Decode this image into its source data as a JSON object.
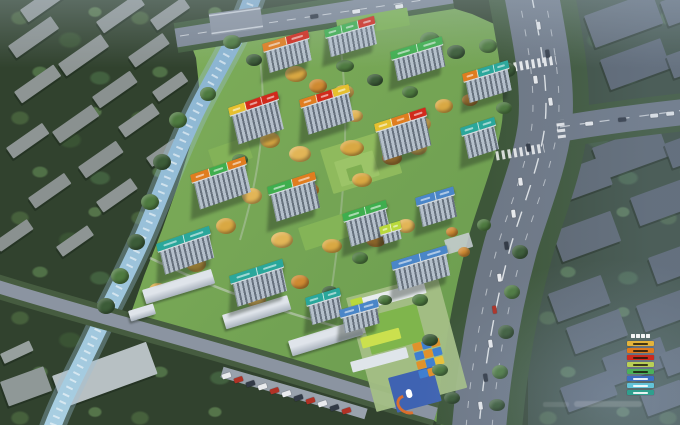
{
  "image": {
    "kind": "aerial-masterplan-render",
    "width": 680,
    "height": 425
  },
  "palette": {
    "banner_orange": "#e07d1f",
    "banner_red": "#d12a1c",
    "banner_yellow": "#e6c02e",
    "banner_green": "#3fae4e",
    "banner_teal": "#2aa79b",
    "banner_blue": "#4a86c8",
    "banner_lime": "#b9d93c",
    "river": "#8fb7d2",
    "road": "#6e7886",
    "dev_green": "#76a455",
    "forest": "#31422e",
    "autumn_tree": "#d9a843"
  },
  "legend": {
    "title_glyphs": 4,
    "entries": [
      {
        "color": "#e3b33b"
      },
      {
        "color": "#df7a1e"
      },
      {
        "color": "#cd2a1e"
      },
      {
        "color": "#b8cf56"
      },
      {
        "color": "#4bb05a"
      },
      {
        "color": "#3c6fc2"
      },
      {
        "color": "#63c3d8"
      },
      {
        "color": "#2f9f8e"
      }
    ]
  },
  "scene": {
    "context": [
      [
        20,
        10,
        58,
        15,
        -35,
        "#8e9594"
      ],
      [
        96,
        22,
        50,
        14,
        -35,
        "#8e9594"
      ],
      [
        8,
        46,
        52,
        15,
        -35,
        "#8a9190"
      ],
      [
        150,
        20,
        40,
        13,
        -35,
        "#8e9594"
      ],
      [
        58,
        64,
        52,
        15,
        -35,
        "#8e9594"
      ],
      [
        128,
        57,
        42,
        13,
        -35,
        "#8a9190"
      ],
      [
        14,
        92,
        48,
        14,
        -35,
        "#8e9594"
      ],
      [
        92,
        97,
        46,
        14,
        -35,
        "#8a9190"
      ],
      [
        152,
        92,
        36,
        12,
        -35,
        "#8e9594"
      ],
      [
        52,
        132,
        48,
        14,
        -35,
        "#8a9190"
      ],
      [
        118,
        127,
        42,
        13,
        -35,
        "#8e9594"
      ],
      [
        6,
        148,
        44,
        13,
        -35,
        "#8e9594"
      ],
      [
        78,
        167,
        46,
        14,
        -35,
        "#8a9190"
      ],
      [
        146,
        158,
        34,
        11,
        -35,
        "#8e9594"
      ],
      [
        28,
        198,
        44,
        13,
        -35,
        "#8a9190"
      ],
      [
        96,
        202,
        42,
        13,
        -35,
        "#8e9594"
      ],
      [
        -6,
        242,
        40,
        12,
        -35,
        "#8a9190"
      ],
      [
        56,
        247,
        38,
        12,
        -35,
        "#8e9594"
      ],
      [
        584,
        16,
        72,
        34,
        -20,
        "#5d6772"
      ],
      [
        660,
        2,
        40,
        26,
        -20,
        "#5d6772"
      ],
      [
        600,
        60,
        64,
        32,
        -20,
        "#5a6470"
      ],
      [
        666,
        56,
        32,
        24,
        -20,
        "#5d6772"
      ],
      [
        592,
        148,
        70,
        34,
        -20,
        "#5d6772"
      ],
      [
        664,
        144,
        32,
        26,
        -20,
        "#5a6470"
      ],
      [
        548,
        176,
        58,
        30,
        -20,
        "#5d6772"
      ],
      [
        630,
        198,
        54,
        30,
        -20,
        "#5a6470"
      ],
      [
        552,
        232,
        62,
        32,
        -20,
        "#5d6772"
      ],
      [
        648,
        258,
        40,
        28,
        -20,
        "#5a6470"
      ],
      [
        548,
        294,
        56,
        30,
        -20,
        "#5d6772"
      ],
      [
        636,
        306,
        48,
        28,
        -20,
        "#5a6470"
      ],
      [
        566,
        328,
        56,
        28,
        -20,
        "#5d6772"
      ],
      [
        602,
        358,
        62,
        30,
        -20,
        "#5a6470"
      ],
      [
        660,
        354,
        32,
        24,
        -20,
        "#5d6772"
      ],
      [
        560,
        388,
        52,
        26,
        -20,
        "#5a6470"
      ],
      [
        640,
        394,
        42,
        24,
        -20,
        "#5d6772"
      ],
      [
        52,
        376,
        100,
        34,
        -20,
        "#b7c0c3"
      ],
      [
        0,
        382,
        46,
        26,
        -20,
        "#8f9897"
      ],
      [
        0,
        354,
        32,
        11,
        -25,
        "#97a09e"
      ]
    ],
    "towers": [
      {
        "x": 262,
        "y": 44,
        "l": 48,
        "fh": 22,
        "r": -17,
        "c": [
          "#e07d1f",
          "#d12a1c"
        ]
      },
      {
        "x": 324,
        "y": 30,
        "l": 52,
        "fh": 20,
        "r": -16,
        "c": [
          "#3fae4e",
          "#3fae4e",
          "#d12a1c"
        ]
      },
      {
        "x": 390,
        "y": 52,
        "l": 54,
        "fh": 22,
        "r": -17,
        "c": [
          "#3fae4e",
          "#3fae4e"
        ]
      },
      {
        "x": 462,
        "y": 74,
        "l": 48,
        "fh": 22,
        "r": -17,
        "c": [
          "#e07d1f",
          "#2aa79b",
          "#2aa79b"
        ]
      },
      {
        "x": 228,
        "y": 108,
        "l": 52,
        "fh": 30,
        "r": -19,
        "c": [
          "#e6c02e",
          "#d12a1c",
          "#d12a1c"
        ]
      },
      {
        "x": 299,
        "y": 100,
        "l": 52,
        "fh": 28,
        "r": -18,
        "c": [
          "#e07d1f",
          "#d12a1c",
          "#e6c02e"
        ]
      },
      {
        "x": 374,
        "y": 124,
        "l": 54,
        "fh": 30,
        "r": -18,
        "c": [
          "#e6c02e",
          "#e07d1f",
          "#d12a1c"
        ]
      },
      {
        "x": 460,
        "y": 128,
        "l": 36,
        "fh": 24,
        "r": -18,
        "c": [
          "#2aa79b",
          "#2aa79b"
        ]
      },
      {
        "x": 190,
        "y": 175,
        "l": 58,
        "fh": 28,
        "r": -19,
        "c": [
          "#e07d1f",
          "#3fae4e",
          "#e07d1f"
        ]
      },
      {
        "x": 267,
        "y": 187,
        "l": 50,
        "fh": 28,
        "r": -18,
        "c": [
          "#3fae4e",
          "#e07d1f"
        ]
      },
      {
        "x": 342,
        "y": 214,
        "l": 46,
        "fh": 26,
        "r": -18,
        "c": [
          "#3fae4e",
          "#3fae4e"
        ]
      },
      {
        "x": 415,
        "y": 198,
        "l": 40,
        "fh": 22,
        "r": -17,
        "c": [
          "#4a86c8",
          "#4a86c8"
        ]
      },
      {
        "x": 391,
        "y": 262,
        "l": 58,
        "fh": 22,
        "r": -17,
        "c": [
          "#4a86c8",
          "#4a86c8"
        ]
      },
      {
        "x": 156,
        "y": 244,
        "l": 56,
        "fh": 24,
        "r": -19,
        "c": [
          "#2aa79b",
          "#2aa79b"
        ]
      },
      {
        "x": 229,
        "y": 276,
        "l": 56,
        "fh": 24,
        "r": -18,
        "c": [
          "#2aa79b",
          "#2aa79b"
        ]
      },
      {
        "x": 305,
        "y": 298,
        "l": 36,
        "fh": 20,
        "r": -17,
        "c": [
          "#2aa79b",
          "#2aa79b"
        ]
      },
      {
        "x": 339,
        "y": 310,
        "l": 40,
        "fh": 16,
        "r": -16,
        "c": [
          "#4a86c8",
          "#4a86c8"
        ]
      },
      {
        "x": 379,
        "y": 227,
        "l": 22,
        "fh": 10,
        "r": -17,
        "c": [
          "#b9d93c",
          "#b9d93c"
        ]
      }
    ],
    "lowrise": [
      [
        142,
        290,
        72,
        15,
        -17
      ],
      [
        128,
        311,
        26,
        11,
        -17
      ],
      [
        222,
        315,
        68,
        15,
        -17
      ],
      [
        288,
        341,
        74,
        16,
        -17
      ]
    ],
    "rects": [
      [
        320,
        150,
        72,
        46,
        -17,
        "#8fba5d",
        1
      ],
      [
        334,
        162,
        40,
        26,
        -17,
        "#9cc468",
        1
      ],
      [
        346,
        169,
        16,
        13,
        -17,
        "#7fae52",
        1
      ],
      [
        336,
        20,
        72,
        18,
        -10,
        "#7cb152",
        1
      ],
      [
        298,
        228,
        50,
        24,
        -18,
        "#84b457",
        1
      ],
      [
        208,
        150,
        40,
        22,
        -19,
        "#83b258",
        1
      ],
      [
        444,
        240,
        26,
        15,
        -17,
        "#c9cfd6",
        0.85
      ],
      [
        346,
        298,
        94,
        118,
        -15,
        "#a4bf86",
        0.95
      ],
      [
        354,
        300,
        72,
        12,
        -15,
        "#e8ecef",
        1
      ],
      [
        350,
        300,
        12,
        9,
        -15,
        "#b9d93c",
        1
      ],
      [
        366,
        302,
        9,
        4,
        -15,
        "#4a90d8",
        1
      ],
      [
        382,
        300,
        9,
        4,
        -15,
        "#4a90d8",
        1
      ],
      [
        352,
        326,
        52,
        10,
        -15,
        "#e4e9ed",
        1
      ],
      [
        350,
        362,
        58,
        11,
        -15,
        "#dfe5ea",
        1
      ],
      [
        362,
        318,
        56,
        38,
        -15,
        "#7fb54c",
        1
      ],
      [
        360,
        338,
        40,
        11,
        -15,
        "#cbe04e",
        1
      ],
      [
        388,
        378,
        46,
        36,
        -15,
        "#3f63b2",
        1
      ],
      [
        412,
        344,
        9,
        8,
        -15,
        "#e0922c",
        1
      ],
      [
        421,
        342,
        9,
        8,
        -15,
        "#3f7fd0",
        1
      ],
      [
        430,
        340,
        9,
        8,
        -15,
        "#e0922c",
        1
      ],
      [
        414,
        353,
        9,
        8,
        -15,
        "#3f7fd0",
        1
      ],
      [
        423,
        351,
        9,
        8,
        -15,
        "#e0922c",
        1
      ],
      [
        432,
        349,
        9,
        8,
        -15,
        "#3f7fd0",
        1
      ],
      [
        416,
        362,
        9,
        8,
        -15,
        "#e0922c",
        1
      ],
      [
        425,
        360,
        9,
        8,
        -15,
        "#3f7fd0",
        1
      ],
      [
        434,
        358,
        9,
        8,
        -15,
        "#e8c23a",
        1
      ],
      [
        418,
        371,
        9,
        8,
        -15,
        "#3f7fd0",
        1
      ],
      [
        427,
        369,
        9,
        8,
        -15,
        "#e0922c",
        1
      ],
      [
        436,
        367,
        9,
        8,
        -15,
        "#3f7fd0",
        1
      ],
      [
        405,
        390,
        6,
        9,
        -15,
        "#ffffff",
        1,
        3
      ]
    ],
    "blobs": [
      [
        296,
        74,
        11,
        8,
        "#d9a843"
      ],
      [
        318,
        86,
        9,
        7,
        "#cf8a32"
      ],
      [
        344,
        92,
        10,
        7,
        "#e2b557"
      ],
      [
        270,
        140,
        10,
        8,
        "#d9a843"
      ],
      [
        300,
        154,
        11,
        8,
        "#e2b557"
      ],
      [
        352,
        148,
        12,
        8,
        "#d9a843"
      ],
      [
        392,
        158,
        10,
        7,
        "#cf8a32"
      ],
      [
        418,
        148,
        9,
        7,
        "#e2b557"
      ],
      [
        362,
        180,
        10,
        7,
        "#d9a843"
      ],
      [
        310,
        190,
        9,
        7,
        "#cf8a32"
      ],
      [
        252,
        196,
        10,
        8,
        "#e2b557"
      ],
      [
        226,
        226,
        10,
        8,
        "#d9a843"
      ],
      [
        282,
        240,
        11,
        8,
        "#e2b557"
      ],
      [
        332,
        246,
        10,
        7,
        "#d9a843"
      ],
      [
        376,
        240,
        10,
        7,
        "#cf8a32"
      ],
      [
        406,
        226,
        9,
        7,
        "#e2b557"
      ],
      [
        196,
        264,
        10,
        8,
        "#d9a843"
      ],
      [
        256,
        300,
        10,
        7,
        "#e2b557"
      ],
      [
        300,
        282,
        9,
        7,
        "#cf8a32"
      ],
      [
        158,
        290,
        9,
        7,
        "#d9a843"
      ],
      [
        422,
        124,
        9,
        7,
        "#e2b557"
      ],
      [
        444,
        106,
        9,
        7,
        "#d9a843"
      ],
      [
        470,
        100,
        8,
        6,
        "#cf8a32"
      ],
      [
        355,
        116,
        8,
        6,
        "#e2b557"
      ],
      [
        452,
        232,
        6,
        5,
        "#cf8a32"
      ],
      [
        464,
        252,
        6,
        5,
        "#cf8a32"
      ],
      [
        440,
        258,
        6,
        5,
        "#cf8a32"
      ],
      [
        178,
        120,
        9,
        8,
        "#4e7a40"
      ],
      [
        162,
        162,
        9,
        8,
        "#3c5c38"
      ],
      [
        150,
        202,
        9,
        8,
        "#4e7a40"
      ],
      [
        136,
        242,
        9,
        8,
        "#3c5c38"
      ],
      [
        120,
        276,
        9,
        8,
        "#4e7a40"
      ],
      [
        106,
        306,
        9,
        8,
        "#3c5c38"
      ],
      [
        232,
        42,
        9,
        7,
        "#4e7a40"
      ],
      [
        254,
        60,
        8,
        6,
        "#3c5c38"
      ],
      [
        208,
        94,
        8,
        7,
        "#4e7a40"
      ],
      [
        430,
        40,
        10,
        8,
        "#4e7a40"
      ],
      [
        456,
        52,
        9,
        7,
        "#3c5c38"
      ],
      [
        488,
        46,
        9,
        7,
        "#4e7a40"
      ],
      [
        508,
        70,
        8,
        7,
        "#3c5c38"
      ],
      [
        504,
        108,
        8,
        6,
        "#4e7a40"
      ],
      [
        520,
        252,
        8,
        7,
        "#3c5c38"
      ],
      [
        512,
        292,
        8,
        7,
        "#4e7a40"
      ],
      [
        506,
        332,
        8,
        7,
        "#3c5c38"
      ],
      [
        500,
        372,
        8,
        7,
        "#4e7a40"
      ],
      [
        497,
        405,
        8,
        6,
        "#3c5c38"
      ],
      [
        484,
        225,
        7,
        6,
        "#4e7a40"
      ],
      [
        345,
        66,
        9,
        6,
        "#4e7a40"
      ],
      [
        375,
        80,
        8,
        6,
        "#3c5c38"
      ],
      [
        410,
        92,
        8,
        6,
        "#4e7a40"
      ],
      [
        240,
        160,
        8,
        6,
        "#4e7a40"
      ],
      [
        215,
        190,
        8,
        6,
        "#3c5c38"
      ],
      [
        290,
        210,
        8,
        6,
        "#4e7a40"
      ],
      [
        360,
        258,
        8,
        6,
        "#4e7a40"
      ],
      [
        330,
        292,
        8,
        6,
        "#3c5c38"
      ],
      [
        385,
        300,
        7,
        5,
        "#4e7a40"
      ],
      [
        420,
        300,
        8,
        6,
        "#4e7a40"
      ],
      [
        430,
        340,
        8,
        6,
        "#3c5c38"
      ],
      [
        440,
        370,
        8,
        6,
        "#4e7a40"
      ],
      [
        452,
        398,
        8,
        6,
        "#3c5c38"
      ]
    ],
    "cars": [
      [
        536,
        22,
        4,
        8,
        -8,
        "#e9ebee"
      ],
      [
        545,
        50,
        4,
        8,
        -8,
        "#323a46"
      ],
      [
        533,
        76,
        4,
        8,
        -8,
        "#e9ebee"
      ],
      [
        548,
        98,
        4,
        8,
        -8,
        "#e9ebee"
      ],
      [
        526,
        144,
        4,
        8,
        -8,
        "#323a46"
      ],
      [
        518,
        178,
        4,
        8,
        -8,
        "#e9ebee"
      ],
      [
        511,
        210,
        4,
        8,
        -8,
        "#e9ebee"
      ],
      [
        504,
        242,
        4,
        8,
        -8,
        "#323a46"
      ],
      [
        497,
        274,
        4,
        8,
        -8,
        "#e9ebee"
      ],
      [
        492,
        306,
        4,
        8,
        -8,
        "#b03226"
      ],
      [
        488,
        340,
        4,
        8,
        -8,
        "#e9ebee"
      ],
      [
        483,
        374,
        4,
        8,
        -8,
        "#323a46"
      ],
      [
        478,
        402,
        4,
        8,
        -8,
        "#e9ebee"
      ],
      [
        585,
        122,
        8,
        4,
        -5,
        "#e9ebee"
      ],
      [
        618,
        118,
        8,
        4,
        -5,
        "#323a46"
      ],
      [
        650,
        114,
        8,
        4,
        -5,
        "#e9ebee"
      ],
      [
        666,
        112,
        8,
        4,
        -5,
        "#e9ebee"
      ],
      [
        310,
        15,
        8,
        4,
        -8,
        "#323a46"
      ],
      [
        352,
        10,
        8,
        4,
        -8,
        "#e9ebee"
      ],
      [
        395,
        5,
        8,
        4,
        -8,
        "#e9ebee"
      ],
      [
        230,
        372,
        5,
        9,
        72,
        "#e9ebee"
      ],
      [
        242,
        376,
        5,
        9,
        72,
        "#b03226"
      ],
      [
        254,
        380,
        5,
        9,
        72,
        "#323a46"
      ],
      [
        266,
        383,
        5,
        9,
        72,
        "#e9ebee"
      ],
      [
        278,
        387,
        5,
        9,
        72,
        "#b03226"
      ],
      [
        290,
        390,
        5,
        9,
        72,
        "#e9ebee"
      ],
      [
        302,
        394,
        5,
        9,
        72,
        "#323a46"
      ],
      [
        314,
        397,
        5,
        9,
        72,
        "#b03226"
      ],
      [
        326,
        400,
        5,
        9,
        72,
        "#e9ebee"
      ],
      [
        338,
        404,
        5,
        9,
        72,
        "#323a46"
      ],
      [
        350,
        407,
        5,
        9,
        72,
        "#b03226"
      ]
    ]
  }
}
